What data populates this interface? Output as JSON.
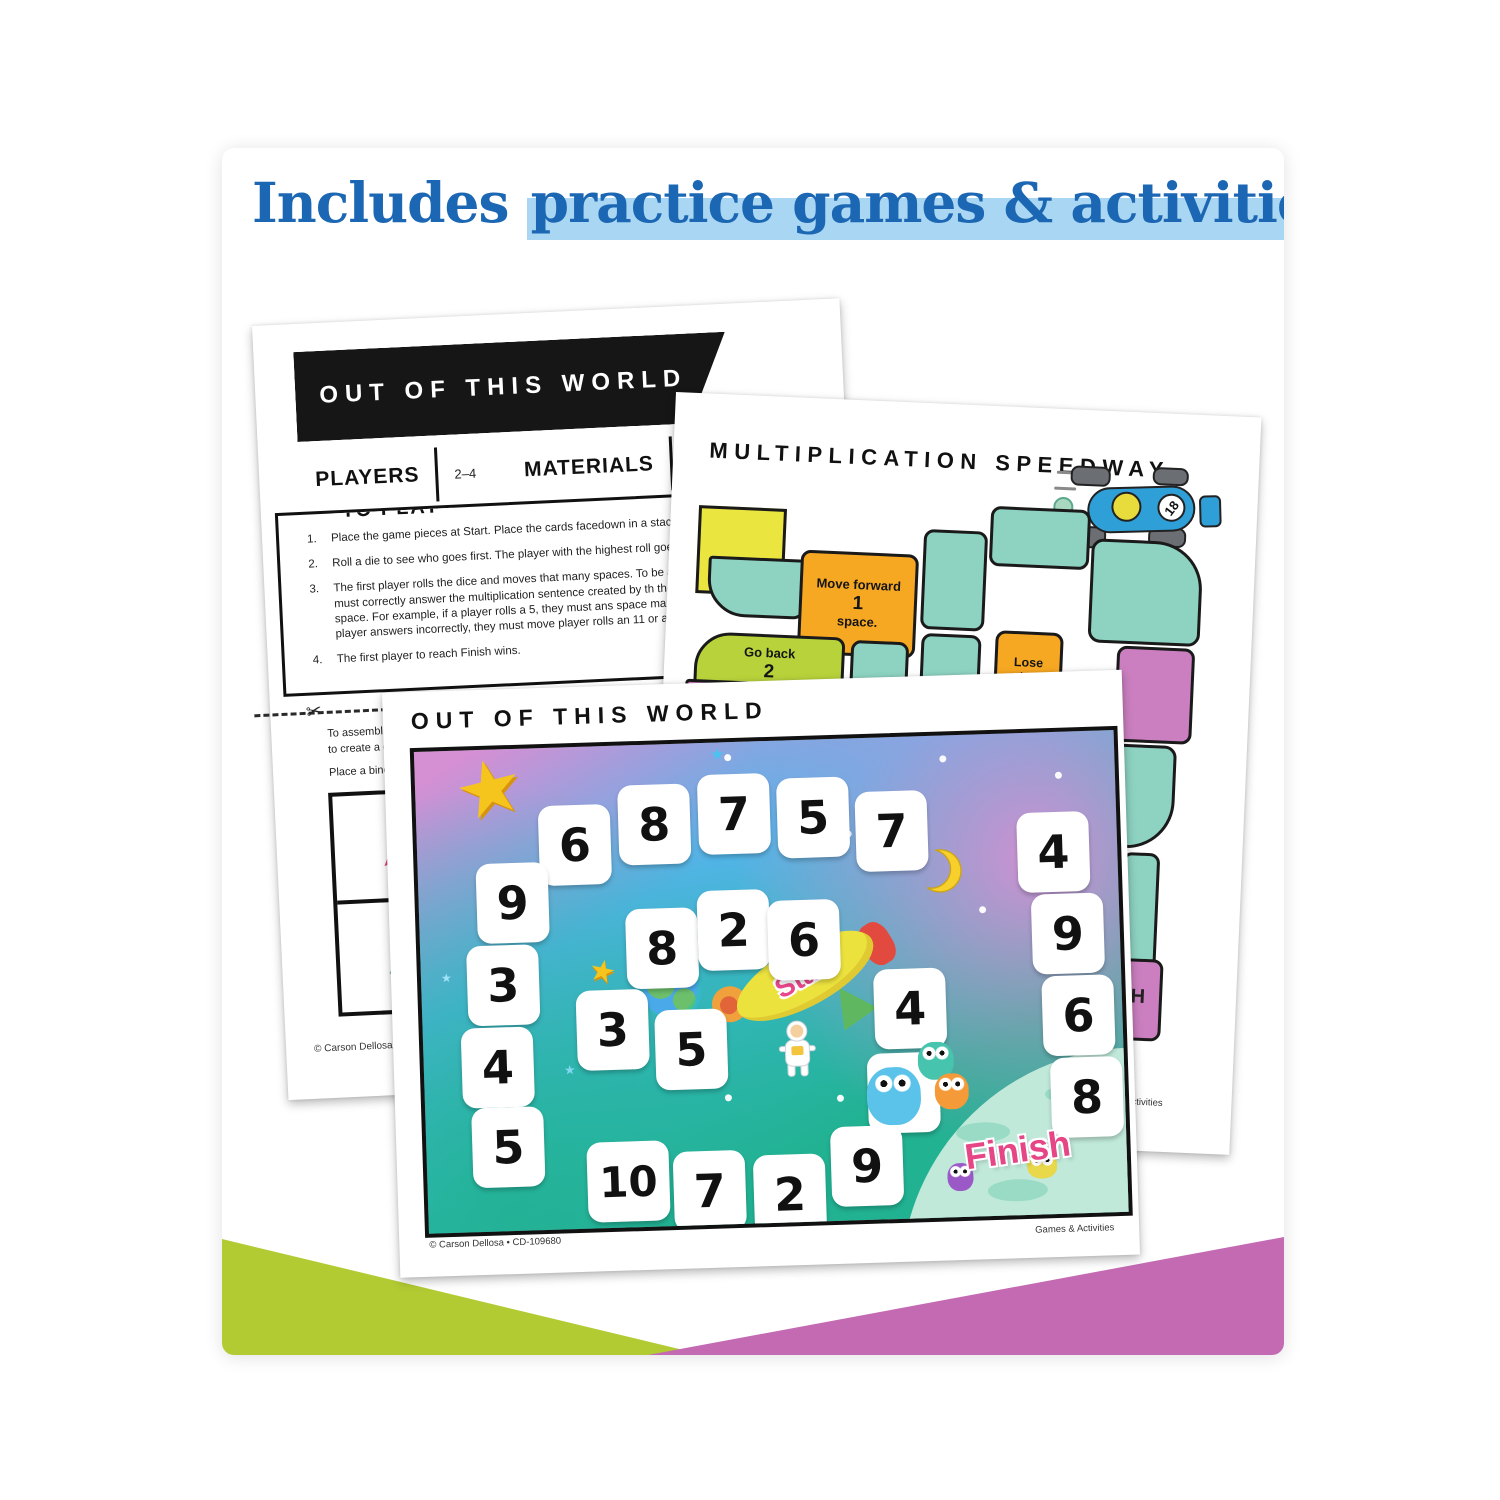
{
  "header": {
    "title_start": "Includes ",
    "title_highlight": "practice games & activities"
  },
  "instructions_page": {
    "banner": "OUT OF THIS WORLD",
    "players_label": "PLAYERS",
    "players_value": "2–4",
    "materials_label": "MATERIALS",
    "materials_items": [
      "2 dice",
      "1 counter or game"
    ],
    "to_play_label": "TO PLAY",
    "steps": [
      {
        "num": "1.",
        "text": "Place the game pieces at Start. Place the cards facedown in a stack."
      },
      {
        "num": "2.",
        "text": "Roll a die to see who goes first. The player with the highest roll goes first."
      },
      {
        "num": "3.",
        "text": "The first player rolls the dice and moves that many spaces. To be able to s the player must correctly answer the multiplication sentence created by th the number on the space. For example, if a player rolls a 5, they must ans space marked with a 3. If the player answers incorrectly, they must move player rolls an 11 or a 12, he loses a turn."
      },
      {
        "num": "4.",
        "text": "The first player to reach Finish wins."
      }
    ],
    "assembly_note_line1": "To assembl",
    "assembly_note_line2": "to create a c",
    "assembly_note_line3": "Place a bind",
    "footer_left": "© Carson Dellosa • CD-"
  },
  "speedway_page": {
    "title": "MULTIPLICATION SPEEDWAY",
    "start_label": "START",
    "car_number": "18",
    "move_forward_space": {
      "line1": "Move forward",
      "line2": "1",
      "line3": "space."
    },
    "go_back_space": {
      "line1": "Go back",
      "line2": "2",
      "line3": "spaces."
    },
    "lose_turn_space": {
      "line1": "Lose",
      "line2": "a turn."
    },
    "finish_visible_text": "H",
    "footer_right": "Games & Activities"
  },
  "board_page": {
    "title": "OUT OF THIS WORLD",
    "start_label": "Start",
    "finish_label": "Finish",
    "tiles": [
      "6",
      "8",
      "7",
      "5",
      "7",
      "4",
      "9",
      "6",
      "8",
      "9",
      "3",
      "4",
      "5",
      "8",
      "2",
      "6",
      "3",
      "5",
      "4",
      "3",
      "10",
      "7",
      "2",
      "9"
    ],
    "footer_left": "© Carson Dellosa • CD-109680",
    "footer_right": "Games & Activities"
  },
  "colors": {
    "title_blue": "#1c67b3",
    "highlight_blue": "#a9d6f2",
    "triangle_green": "#b2cb33",
    "triangle_purple": "#c36ab3",
    "track_teal": "#8ed3c2",
    "track_orange": "#f7a823",
    "track_green": "#b8d23b",
    "track_purple": "#cb7fc0",
    "start_yellow": "#ebe63f",
    "start_finish_pink": "#e64586"
  }
}
